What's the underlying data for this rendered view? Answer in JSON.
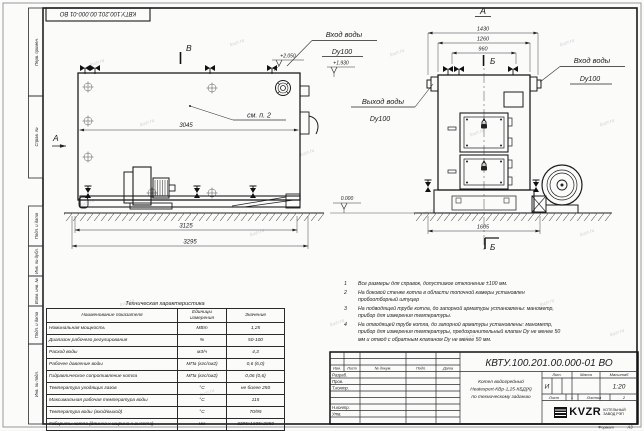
{
  "watermark": "kvzr.ru",
  "stamp": "КВТУ.100.201.00.000-01  ВО",
  "frame": {
    "left_labels": [
      "Перв. примен.",
      "Справ. №",
      "Подп. и дата",
      "Инв. № дубл.",
      "Взам. инв. №",
      "Подп. и дата",
      "Инв. № подл."
    ]
  },
  "side_view": {
    "marker_b": "В",
    "marker_a": "А",
    "see_item": "см. п. 2",
    "elev_top": "+2.050",
    "elev_inlet": "+1.930",
    "inlet_line1": "Вход воды",
    "inlet_line2": "Dy100",
    "dim_body": "3045",
    "dim_skid": "3125",
    "dim_overall": "3295"
  },
  "front_view": {
    "title": "А",
    "marker_section": "Б",
    "dim_width_overall": "1430",
    "dim_width_body": "1260",
    "dim_width_valves": "960",
    "dim_base": "1605",
    "outlet_line1": "Выход воды",
    "outlet_line2": "Dy100",
    "inlet_line1": "Вход воды",
    "inlet_line2": "Dy100",
    "elev_zero": "0.000"
  },
  "tech_table": {
    "title": "Техническая характеристика",
    "headers": [
      "Наименование показателя",
      "Единицы измерения",
      "Значение"
    ],
    "rows": [
      [
        "Номинальная мощность",
        "МВт",
        "1,25"
      ],
      [
        "Диапазон рабочего регулирования",
        "%",
        "50-100"
      ],
      [
        "Расход воды",
        "м3/ч",
        "4,3"
      ],
      [
        "Рабочее давление воды",
        "МПа (кгс/см2)",
        "0,6 (6,0)"
      ],
      [
        "Гидравлическое сопротивление котла",
        "МПа (кгс/см2)",
        "0,06 (0,6)"
      ],
      [
        "Температура уходящих газов",
        "°С",
        "не более 250"
      ],
      [
        "Максимальная рабочая температура воды",
        "°С",
        "115"
      ],
      [
        "Температура воды (вход/выход)",
        "°С",
        "70/95"
      ],
      [
        "Габариты котла (длинна х ширина х высота)",
        "мм",
        "3295х1605х2050"
      ]
    ]
  },
  "notes": [
    {
      "num": "1",
      "text": "Все размеры для справок, допустимое отклонение ±100 мм."
    },
    {
      "num": "2",
      "text": "На боковой стенке котла в области топочной камеры установлен пробоотборный штуцер"
    },
    {
      "num": "3",
      "text": "На  подводящей трубе котла, до запорной арматуры установлены: манометр, прибор для измерения температуры."
    },
    {
      "num": "4",
      "text": "На отводящей трубе котла, до запорной арматуры установлены: манометр, прибор для измерения температуры, предохранительный клапан Dy не менее 50 мм и отвод с обратным клапаном Dy не менее 50 мм."
    }
  ],
  "title_block": {
    "doc_number": "КВТУ.100.201.00.000-01  ВО",
    "name_line1": "Котел водогрейный",
    "name_line2": "Heatexpert-КВр-1,25-КБД(К)",
    "name_line3": "по техническому заданию",
    "lit_header": "Лит.",
    "mass_header": "Масса",
    "scale_header": "Масштаб",
    "lit_value": "И",
    "scale_value": "1:20",
    "sheet_label": "Лист",
    "sheet_value": "1",
    "sheets_label": "Листов",
    "sheets_value": "2",
    "col_headers": [
      "Изм.",
      "Лист",
      "№ докум.",
      "Подп.",
      "Дата"
    ],
    "roles": [
      "Разраб.",
      "Пров.",
      "Т.контр.",
      "Н.контр.",
      "Утв."
    ],
    "logo_word": "KVZR",
    "company_line1": "КОТЕЛЬНЫЙ",
    "company_line2": "ЗАВОД РЭП",
    "format_label": "Формат",
    "format_value": "А3"
  }
}
